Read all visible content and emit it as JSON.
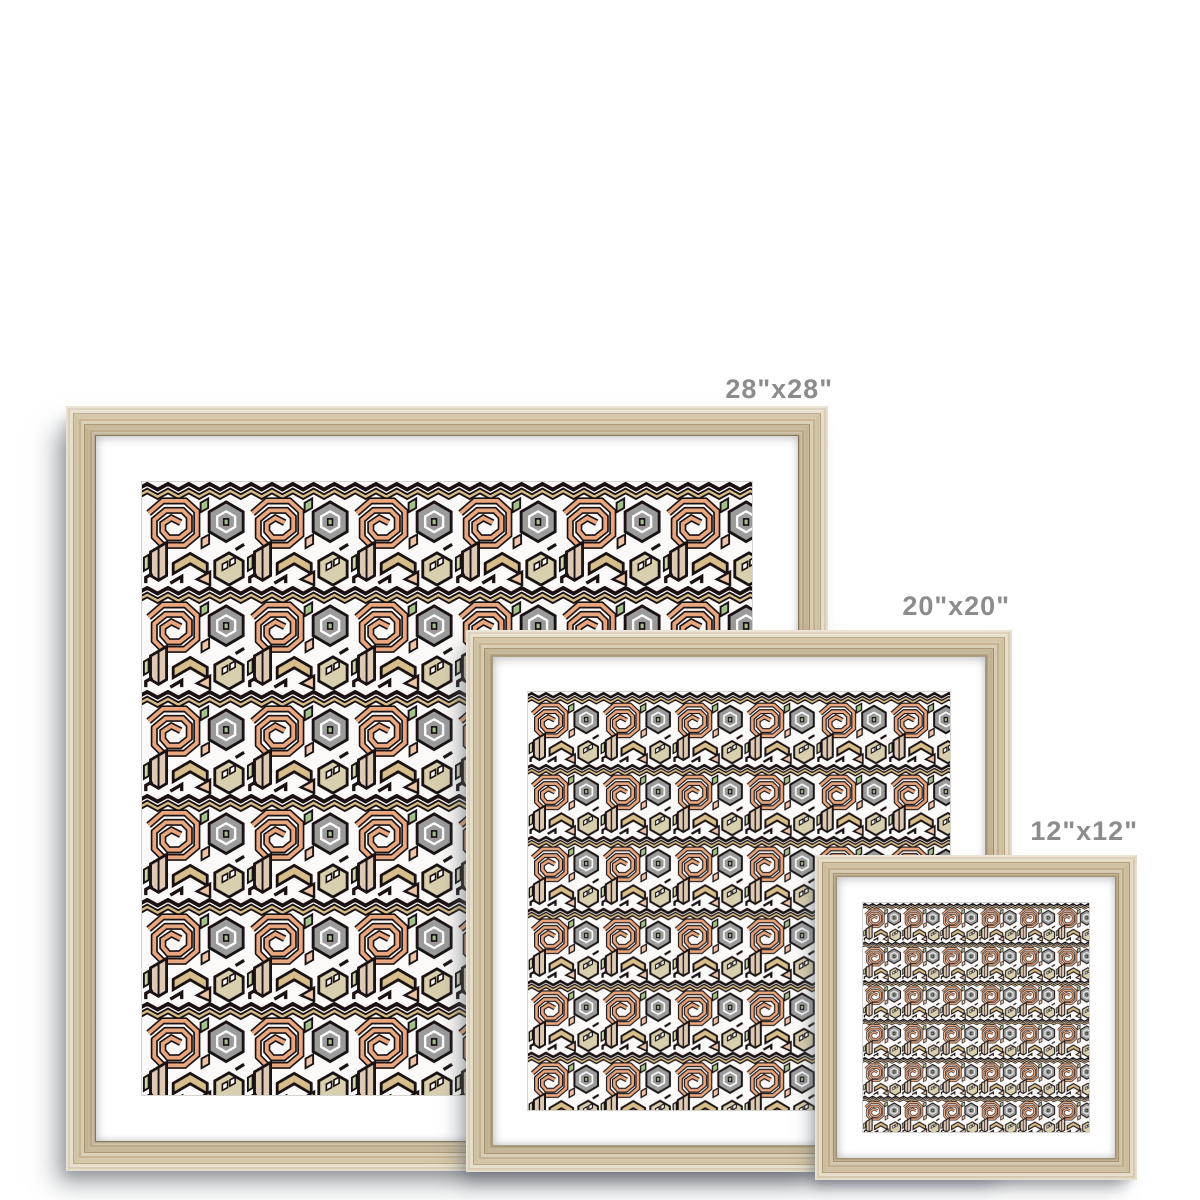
{
  "page": {
    "background_color": "#ffffff",
    "description": "Framed art print size comparison mockup, three natural wood frames on white"
  },
  "prints": [
    {
      "name": "framed print 28 inch",
      "size_label": "28\"x28\""
    },
    {
      "name": "framed print 20 inch",
      "size_label": "20\"x20\""
    },
    {
      "name": "framed print 12 inch",
      "size_label": "12\"x12\""
    }
  ],
  "label_style": {
    "color": "#8c8c8c"
  },
  "frame_style": {
    "material": "natural-wood",
    "wood_light": "#e3d9c1",
    "wood_mid": "#cbb999",
    "wood_dark": "#ad9a76",
    "mat_color": "#ffffff"
  },
  "artwork": {
    "subject": "abstract geometric isometric maze pattern",
    "background": "#fbfaf8",
    "outline_color": "#191112",
    "palette": [
      "#e9a77f",
      "#ecc3a8",
      "#d7bd8a",
      "#d8cfae",
      "#ddc9b4",
      "#9b9b9c",
      "#a4c18e",
      "#c9d6ae"
    ]
  }
}
